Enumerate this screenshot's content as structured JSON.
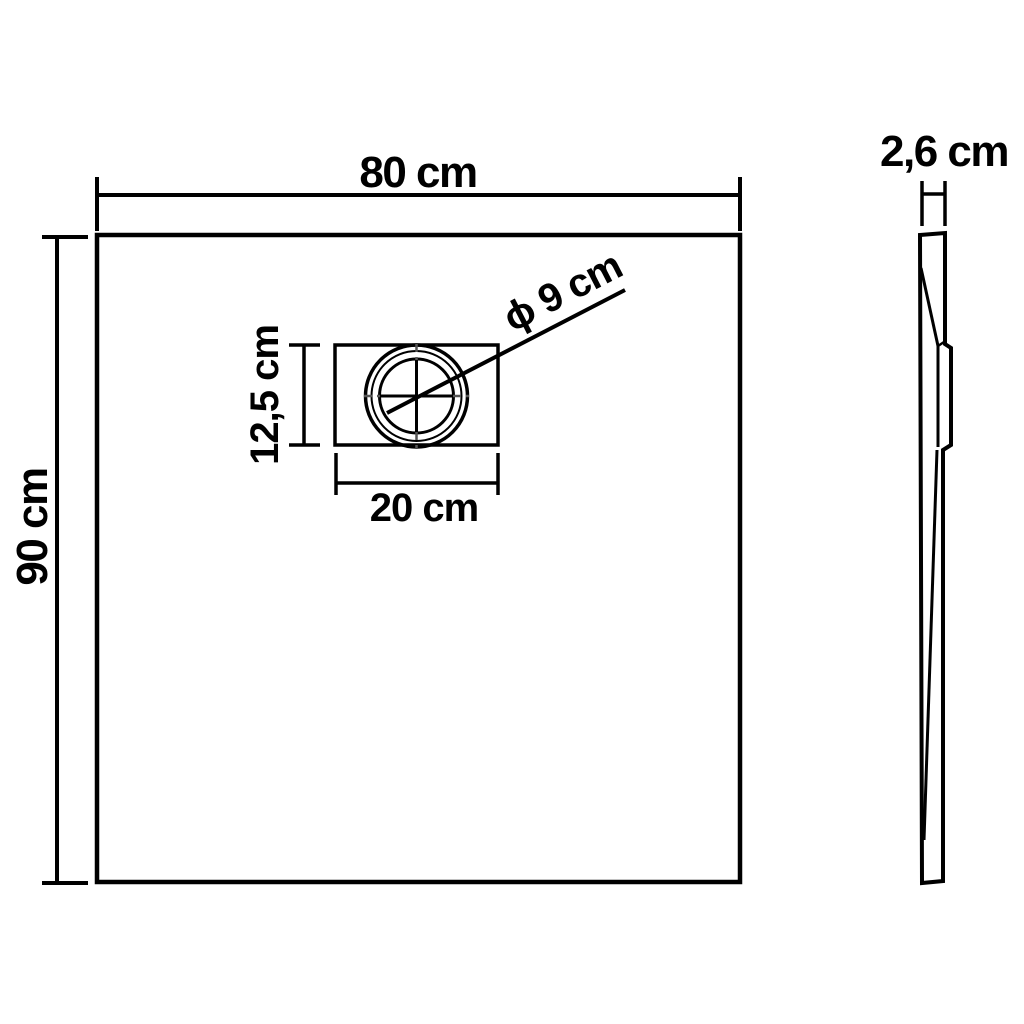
{
  "diagram": {
    "type": "technical-dimension-drawing",
    "subject": "shower-tray",
    "front_view": {
      "width_label": "80 cm",
      "height_label": "90 cm",
      "drain": {
        "plate_width_label": "20 cm",
        "plate_height_label": "12,5 cm",
        "diameter_label": "ϕ 9 cm"
      }
    },
    "side_view": {
      "thickness_label": "2,6 cm"
    },
    "colors": {
      "line": "#000000",
      "background": "#ffffff",
      "centerline": "#555555"
    }
  }
}
